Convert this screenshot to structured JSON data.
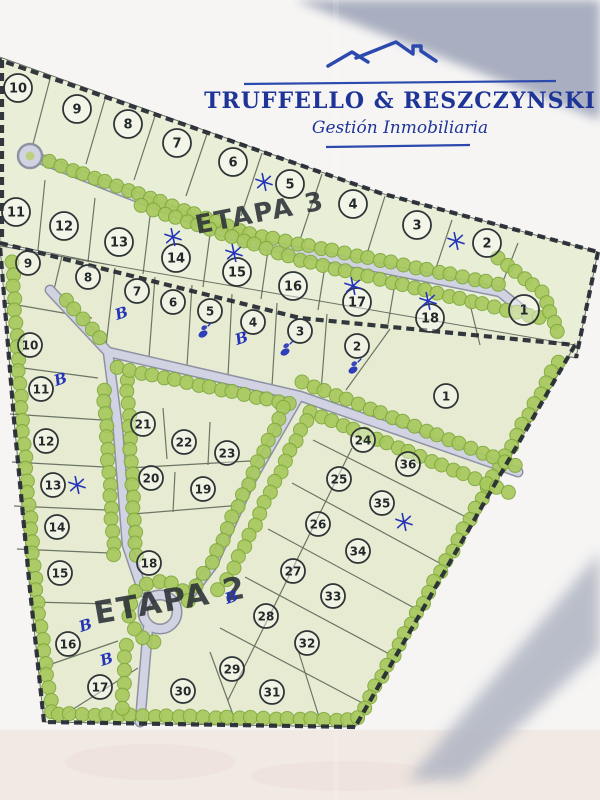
{
  "logo": {
    "title": "TRUFFELLO & RESZCZYNSKI",
    "subtitle": "Gestión Inmobiliaria",
    "color": "#1e3597"
  },
  "map": {
    "stages": [
      {
        "id": "etapa3",
        "label": "ETAPA 3",
        "lot_style": {
          "r": 14,
          "font": 13
        },
        "lots": [
          {
            "n": "10",
            "x": 18,
            "y": 88
          },
          {
            "n": "9",
            "x": 77,
            "y": 109
          },
          {
            "n": "8",
            "x": 128,
            "y": 124
          },
          {
            "n": "7",
            "x": 177,
            "y": 143
          },
          {
            "n": "6",
            "x": 233,
            "y": 162
          },
          {
            "n": "5",
            "x": 290,
            "y": 184
          },
          {
            "n": "4",
            "x": 353,
            "y": 204
          },
          {
            "n": "3",
            "x": 417,
            "y": 225
          },
          {
            "n": "2",
            "x": 487,
            "y": 243
          },
          {
            "n": "11",
            "x": 16,
            "y": 212
          },
          {
            "n": "12",
            "x": 64,
            "y": 226
          },
          {
            "n": "13",
            "x": 119,
            "y": 242
          },
          {
            "n": "14",
            "x": 176,
            "y": 258
          },
          {
            "n": "15",
            "x": 237,
            "y": 272
          },
          {
            "n": "16",
            "x": 293,
            "y": 286
          },
          {
            "n": "17",
            "x": 357,
            "y": 302
          },
          {
            "n": "18",
            "x": 430,
            "y": 318
          },
          {
            "n": "1",
            "x": 524,
            "y": 310,
            "r": 15
          }
        ]
      },
      {
        "id": "etapa2",
        "label": "ETAPA 2",
        "lot_style": {
          "r": 12,
          "font": 12
        },
        "lots": [
          {
            "n": "9",
            "x": 28,
            "y": 263
          },
          {
            "n": "8",
            "x": 88,
            "y": 277
          },
          {
            "n": "7",
            "x": 137,
            "y": 291
          },
          {
            "n": "6",
            "x": 173,
            "y": 302
          },
          {
            "n": "5",
            "x": 210,
            "y": 311
          },
          {
            "n": "4",
            "x": 253,
            "y": 322
          },
          {
            "n": "3",
            "x": 300,
            "y": 331
          },
          {
            "n": "2",
            "x": 357,
            "y": 346
          },
          {
            "n": "1",
            "x": 446,
            "y": 396
          },
          {
            "n": "10",
            "x": 30,
            "y": 345
          },
          {
            "n": "11",
            "x": 41,
            "y": 389
          },
          {
            "n": "12",
            "x": 46,
            "y": 441
          },
          {
            "n": "13",
            "x": 53,
            "y": 485
          },
          {
            "n": "14",
            "x": 57,
            "y": 527
          },
          {
            "n": "15",
            "x": 60,
            "y": 573
          },
          {
            "n": "16",
            "x": 68,
            "y": 644
          },
          {
            "n": "17",
            "x": 100,
            "y": 687
          },
          {
            "n": "21",
            "x": 143,
            "y": 424
          },
          {
            "n": "22",
            "x": 184,
            "y": 442
          },
          {
            "n": "23",
            "x": 227,
            "y": 453
          },
          {
            "n": "20",
            "x": 151,
            "y": 478
          },
          {
            "n": "19",
            "x": 203,
            "y": 489
          },
          {
            "n": "18",
            "x": 149,
            "y": 563
          },
          {
            "n": "24",
            "x": 363,
            "y": 440
          },
          {
            "n": "36",
            "x": 408,
            "y": 464
          },
          {
            "n": "25",
            "x": 339,
            "y": 479
          },
          {
            "n": "35",
            "x": 382,
            "y": 503
          },
          {
            "n": "26",
            "x": 318,
            "y": 524
          },
          {
            "n": "34",
            "x": 358,
            "y": 551
          },
          {
            "n": "27",
            "x": 293,
            "y": 571
          },
          {
            "n": "33",
            "x": 333,
            "y": 596
          },
          {
            "n": "28",
            "x": 266,
            "y": 616
          },
          {
            "n": "32",
            "x": 307,
            "y": 643
          },
          {
            "n": "29",
            "x": 232,
            "y": 669
          },
          {
            "n": "31",
            "x": 272,
            "y": 692
          },
          {
            "n": "30",
            "x": 183,
            "y": 691
          }
        ]
      }
    ],
    "marks": {
      "ink_color": "#2434b8",
      "asterisks": [
        {
          "x": 264,
          "y": 182
        },
        {
          "x": 456,
          "y": 241
        },
        {
          "x": 173,
          "y": 237
        },
        {
          "x": 234,
          "y": 253
        },
        {
          "x": 353,
          "y": 286
        },
        {
          "x": 428,
          "y": 301
        },
        {
          "x": 77,
          "y": 485
        },
        {
          "x": 404,
          "y": 522
        }
      ],
      "b_letters": [
        {
          "ch": "B",
          "x": 123,
          "y": 318
        },
        {
          "ch": "B",
          "x": 243,
          "y": 343
        },
        {
          "ch": "B",
          "x": 62,
          "y": 384
        },
        {
          "ch": "B",
          "x": 233,
          "y": 602
        },
        {
          "ch": "B",
          "x": 87,
          "y": 630
        },
        {
          "ch": "B",
          "x": 108,
          "y": 664
        }
      ],
      "scribbles": [
        {
          "x": 203,
          "y": 334
        },
        {
          "x": 285,
          "y": 352
        },
        {
          "x": 353,
          "y": 370
        }
      ]
    },
    "palette": {
      "parcel": "#e7ecd3",
      "road_fill": "#d2d3e2",
      "road_edge": "#8d92a4",
      "tree": "#a8c95e",
      "tree_edge": "#7fa83c",
      "boundary": "#232832",
      "parcel_line": "#566052",
      "circle_stroke": "#2f3537"
    }
  }
}
